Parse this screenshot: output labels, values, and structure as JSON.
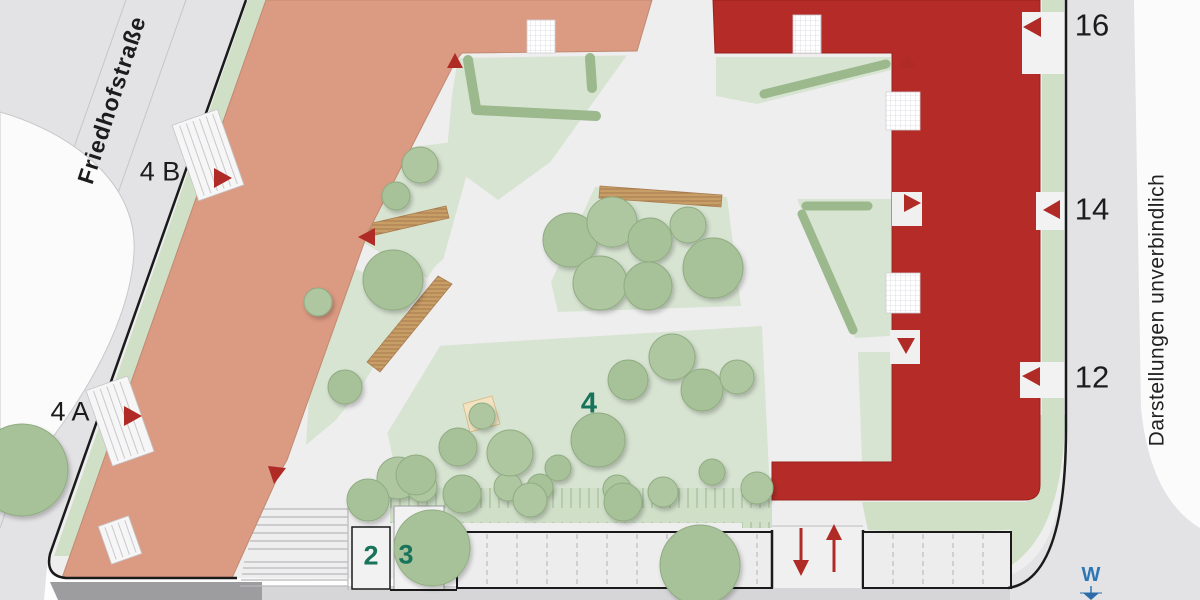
{
  "plan": {
    "street_name": "Friedhofstraße",
    "disclaimer": "Darstellungen unverbindlich",
    "compass": {
      "west": "W"
    },
    "house_numbers": {
      "left_b": "4 B",
      "left_a": "4 A",
      "right_16": "16",
      "right_14": "14",
      "right_12": "12"
    },
    "area_labels": {
      "area_2": "2",
      "area_3": "3",
      "area_4": "4"
    },
    "colors": {
      "building_left_salmon": "#db9a82",
      "building_right_red": "#b52b27",
      "street_gray": "#e3e3e5",
      "plaza_gray": "#eeeeef",
      "lawn_green": "#d8e4d2",
      "green_strip": "#cfe0c6",
      "tree_green": "#a7c199",
      "hedge_green": "#9cb88d",
      "bench_wood": "#c89e67",
      "sandbox_sand": "#f2e4c3",
      "entrance_marker_red": "#b12b26",
      "area_label_green": "#17735a",
      "compass_blue": "#2e77b5",
      "boundary_black": "#1a1a1a"
    }
  }
}
